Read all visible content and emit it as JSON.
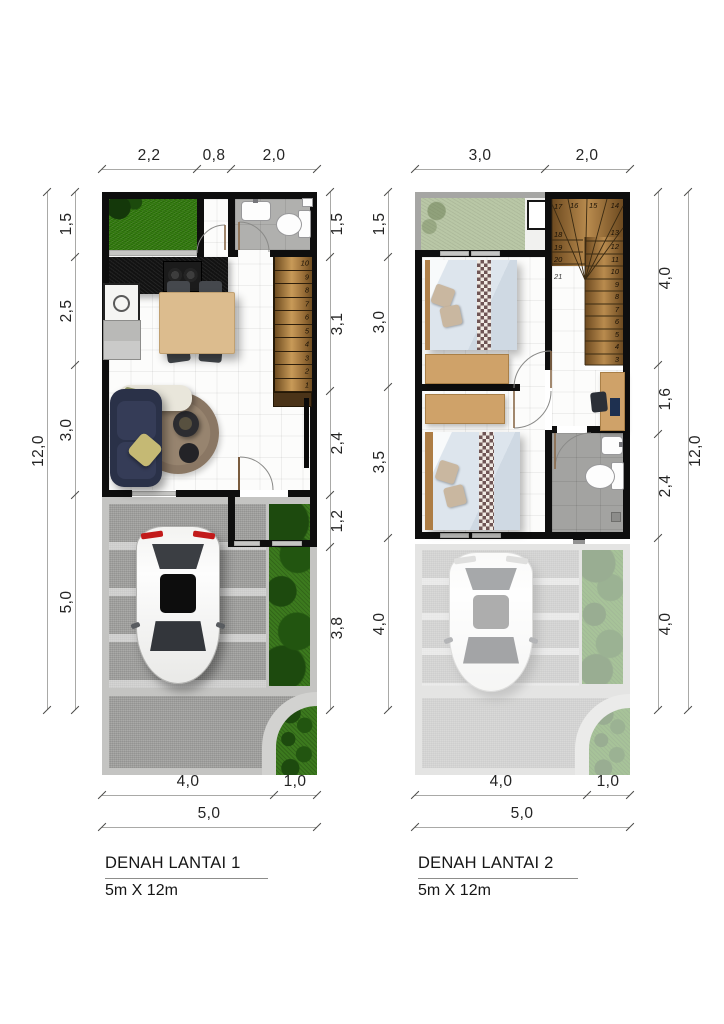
{
  "document": {
    "type": "floor-plan-drawing",
    "background": "#ffffff"
  },
  "colors": {
    "wall": "#0e0e0e",
    "dim_line": "#a9a9a7",
    "dim_text": "#242424",
    "grass": "#35810f",
    "sage": "#b9c7a6",
    "garden": "#3c7a1e",
    "bath_floor": "#b0b0ae",
    "bath_floor2": "#a3a3a1",
    "stair_wood": "#b1823f",
    "table_wood": "#dcbc8e",
    "desk_wood": "#cfa269",
    "sofa": "#2a3148",
    "rug": "#8d7a68",
    "pillow": "#c5b974",
    "chair": "#45484d",
    "gravel": "#a0a09e",
    "curb": "#c6c6c4",
    "taillight": "#c21a1a",
    "fade": "rgba(255,255,255,0.55)"
  },
  "plans": [
    {
      "title": "DENAH LANTAI 1",
      "subtitle": "5m X 12m",
      "dims": {
        "top": [
          "2,2",
          "0,8",
          "2,0"
        ],
        "left": [
          "1,5",
          "2,5",
          "3,0",
          "5,0"
        ],
        "left_total": "12,0",
        "right": [
          "1,5",
          "3,1",
          "2,4",
          "1,2",
          "3,8"
        ],
        "bottom": [
          "4,0",
          "1,0"
        ],
        "bottom_total": "5,0"
      },
      "stair_steps": [
        "10",
        "9",
        "8",
        "7",
        "6",
        "5",
        "4",
        "3",
        "2",
        "1"
      ]
    },
    {
      "title": "DENAH LANTAI 2",
      "subtitle": "5m X 12m",
      "dims": {
        "top": [
          "3,0",
          "2,0"
        ],
        "left": [
          "1,5",
          "3,0",
          "3,5",
          "4,0"
        ],
        "right": [
          "4,0",
          "1,6",
          "2,4",
          "4,0"
        ],
        "right_total": "12,0",
        "bottom": [
          "4,0",
          "1,0"
        ],
        "bottom_total": "5,0"
      },
      "stair_steps_top": [
        "17",
        "16",
        "15",
        "14"
      ],
      "stair_steps_left": [
        "18",
        "19",
        "20"
      ],
      "stair_landing": "21",
      "stair_steps_right": [
        "13",
        "12",
        "11",
        "10",
        "9",
        "8",
        "7",
        "6",
        "5",
        "4",
        "3"
      ]
    }
  ]
}
